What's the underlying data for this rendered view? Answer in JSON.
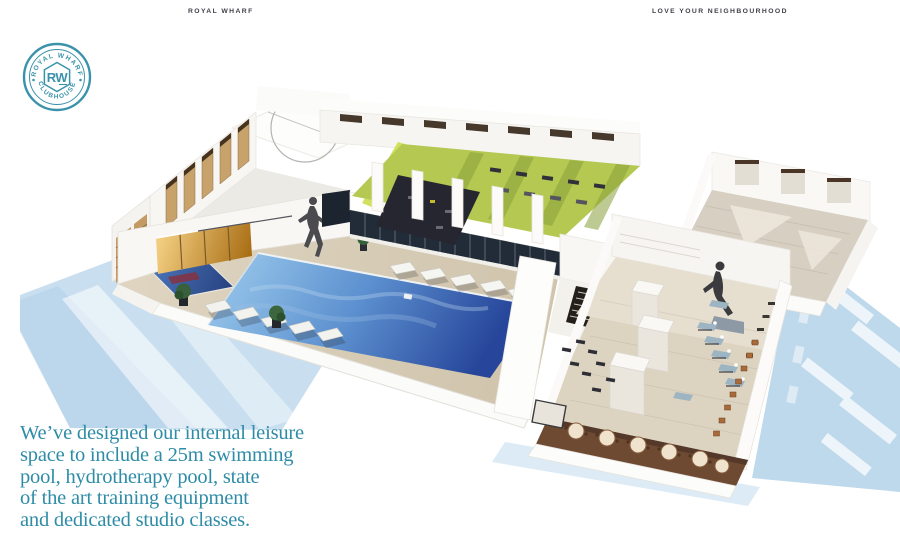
{
  "theme": {
    "accent-teal": "#3a93ab",
    "header-text": "#3f3f49",
    "tagline-text": "#2e8ca7",
    "pool-blue-light": "#8dbde6",
    "pool-blue-dark": "#27469b",
    "hydro-pool-blue": "#30549e",
    "gym-floor-green": "#b5c952",
    "deck-beige": "#d4c9b4",
    "wood-tan": "#c8a26b",
    "shadow-blue": "#c9dff0",
    "page-background": "#ffffff"
  },
  "header": {
    "brand": "ROYAL WHARF",
    "motto": "LOVE YOUR NEIGHBOURHOOD"
  },
  "logo": {
    "arc_top": "ROYAL WHARF",
    "arc_bottom": "CLUBHOUSE",
    "monogram": "RW"
  },
  "tagline": {
    "lines": [
      "We’ve designed our internal leisure",
      "space to include a 25m swimming",
      "pool, hydrotherapy pool, state",
      "of the art training equipment",
      "and dedicated studio classes."
    ]
  },
  "illustration": {
    "alt": "Isometric cutaway 3D render of the clubhouse leisure space: 25m swimming pool, hydrotherapy pool, green-floored gym with training equipment, studio rooms, sun loungers and cafe seating, casting pale blue shadows."
  }
}
